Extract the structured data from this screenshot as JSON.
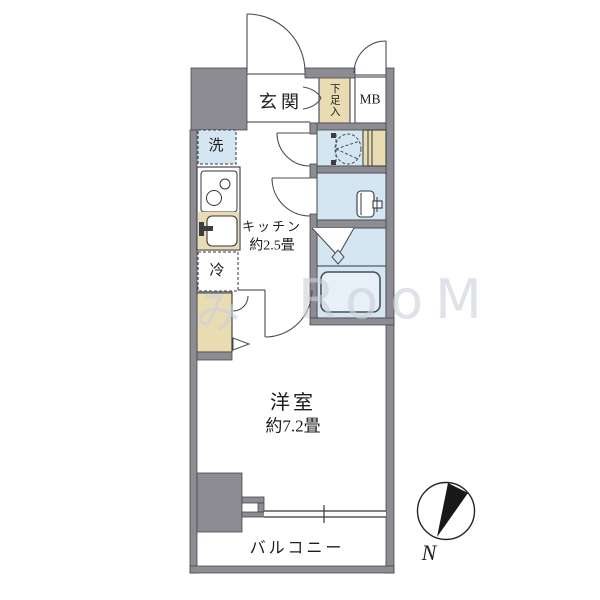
{
  "floorplan": {
    "labels": {
      "genkan": "玄関",
      "shoebox": "下足入",
      "meter_box": "MB",
      "washer": "洗",
      "fridge": "冷",
      "kitchen_line1": "キッチン",
      "kitchen_line2": "約2.5畳",
      "main_room_line1": "洋室",
      "main_room_line2": "約7.2畳",
      "balcony": "バルコニー"
    },
    "compass": {
      "north_label": "N"
    },
    "watermark": {
      "left": "み",
      "right": "RooM"
    },
    "colors": {
      "wall_gray": "#8c8c92",
      "wet_room_blue": "#d5e6f3",
      "storage_tan": "#e9dcb3",
      "bathtub_fill": "#e7f0f8",
      "line_dark": "#33363b"
    }
  }
}
